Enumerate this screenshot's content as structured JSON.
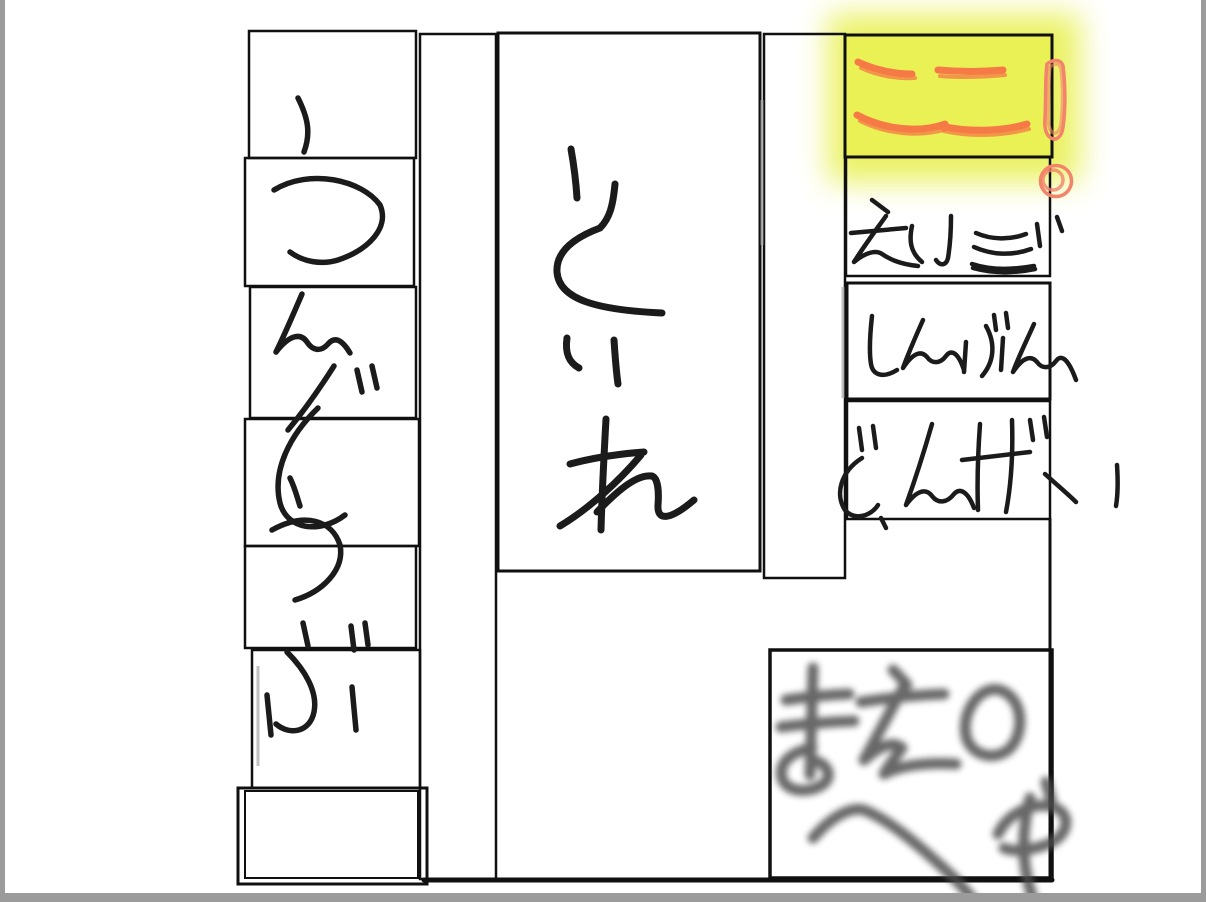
{
  "canvas": {
    "width": 1206,
    "height": 902,
    "background": "#ffffff",
    "frame_color": "#9b9b9b",
    "ink_color": "#141414"
  },
  "highlight": {
    "label": "ここ!",
    "marker_color": "#f67a45",
    "exclamation_color": "#f4836b",
    "fill_color": "#e8f050"
  },
  "rooms": [
    {
      "name": "sports-club-column",
      "label": "うんどうぶ",
      "orientation": "vertical"
    },
    {
      "name": "toilet-room",
      "label": "といれ",
      "orientation": "vertical"
    },
    {
      "name": "here-marker",
      "label": "ここ!",
      "orientation": "horizontal"
    },
    {
      "name": "eigo-room",
      "label": "えいご",
      "orientation": "horizontal"
    },
    {
      "name": "shinbun-room",
      "label": "しんぶん",
      "orientation": "horizontal"
    },
    {
      "name": "bungei-room",
      "label": "ぶんげい",
      "orientation": "horizontal"
    },
    {
      "name": "mae-no-heya-room",
      "label": "まえのへや",
      "lines": [
        "まえの",
        "へや"
      ],
      "style": "soft-blurred-gray"
    }
  ],
  "legend_title": "Hand-drawn room labels"
}
